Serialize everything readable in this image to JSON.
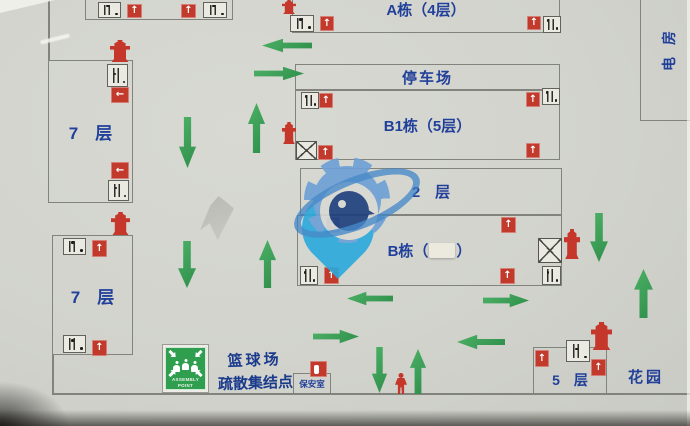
{
  "map_type": "fire-evacuation-site-plan",
  "buildings": {
    "building_a": "A栋（4层）",
    "parking_lot": "停车场",
    "building_b1": "B1栋（5层）",
    "floor_2": "2　层",
    "building_b_prefix": "B栋（",
    "building_b_suffix": "）",
    "tower_7f_upper": "7　层",
    "tower_7f_lower": "7　层",
    "building_5f": "5　层",
    "garden": "花园",
    "electrical_room": "电房",
    "security_room": "保安室"
  },
  "assembly": {
    "label_line1": "篮球场",
    "label_line2": "疏散集结点",
    "sign_text_line1": "ASSEMBLY",
    "sign_text_line2": "POINT"
  },
  "icons": {
    "exit_up_glyph": "↑",
    "exit_left_glyph": "←",
    "exit_sign": "red square with white arrow",
    "stair_sign": "white box with stair hatching",
    "elevator_sign": "white box with X",
    "hydrant_sign": "red fire hydrant silhouette",
    "assembly_sign": "green square, inward arrows, people"
  },
  "colors": {
    "exit_red": "#c13a2c",
    "hydrant_red": "#c5372b",
    "arrow_green": "#3aa157",
    "assembly_green": "#2f9e4e",
    "label_blue": "#21409a",
    "watermark_pin_blue": "#2aa9dc",
    "watermark_gear_blue": "#6b9fd6",
    "paper_grey": "#d2d3cd"
  }
}
